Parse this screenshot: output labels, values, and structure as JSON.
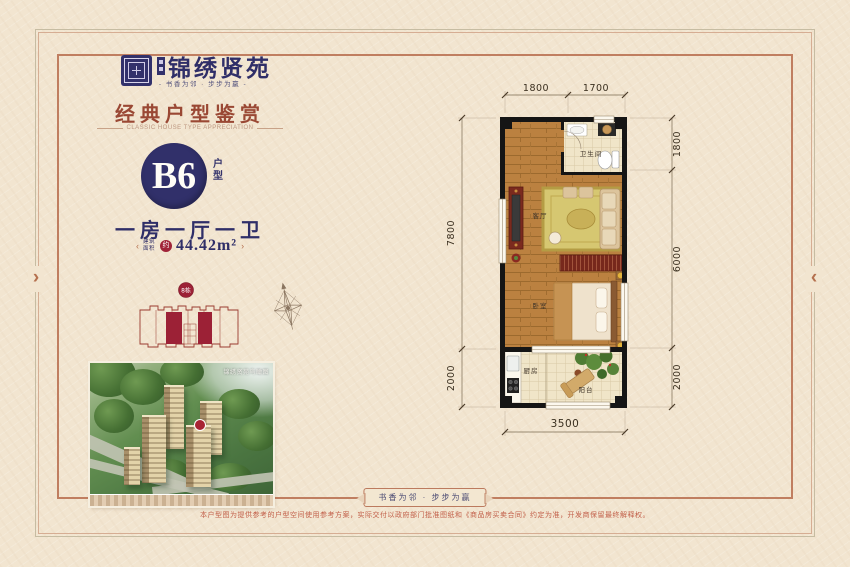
{
  "brand": {
    "name": "锦绣贤苑",
    "tagline": "- 书香为邻 · 步步为赢 -"
  },
  "section": {
    "title": "经典户型鉴赏",
    "subtitle": "CLASSIC HOUSE TYPE APPRECIATION"
  },
  "unit": {
    "code": "B6",
    "code_suffix": "户型",
    "layout": "一房一厅一卫",
    "area_label": "建筑面积",
    "area_prefix": "约",
    "area_value": "44.42m²"
  },
  "site_plan": {
    "badge": "8栋"
  },
  "aerial": {
    "caption": "锦绣贤苑鸟瞰图"
  },
  "floorplan": {
    "rooms": {
      "bathroom": "卫生间",
      "living": "客厅",
      "bedroom": "卧室",
      "kitchen": "厨房",
      "balcony": "阳台"
    },
    "dims": {
      "top": [
        "1800",
        "1700"
      ],
      "right": [
        "1800",
        "6000",
        "2000"
      ],
      "left": [
        "7800",
        "2000"
      ],
      "bottom": "3500"
    }
  },
  "footer": {
    "banner": "书香为邻 · 步步为赢",
    "disclaimer": "本户型图为提供参考的户型空间使用参考方案，实际交付以政府部门批准图纸和《商品房买卖合同》约定为准，开发商保留最终解释权。"
  },
  "ornaments": {
    "left": "›",
    "right": "‹",
    "area_left": "‹",
    "area_right": "›"
  },
  "colors": {
    "navy": "#31306a",
    "title_red": "#9a4834",
    "accent_red": "#a02338",
    "frame": "#c07e60",
    "page_bg": "#f2e5d0"
  }
}
